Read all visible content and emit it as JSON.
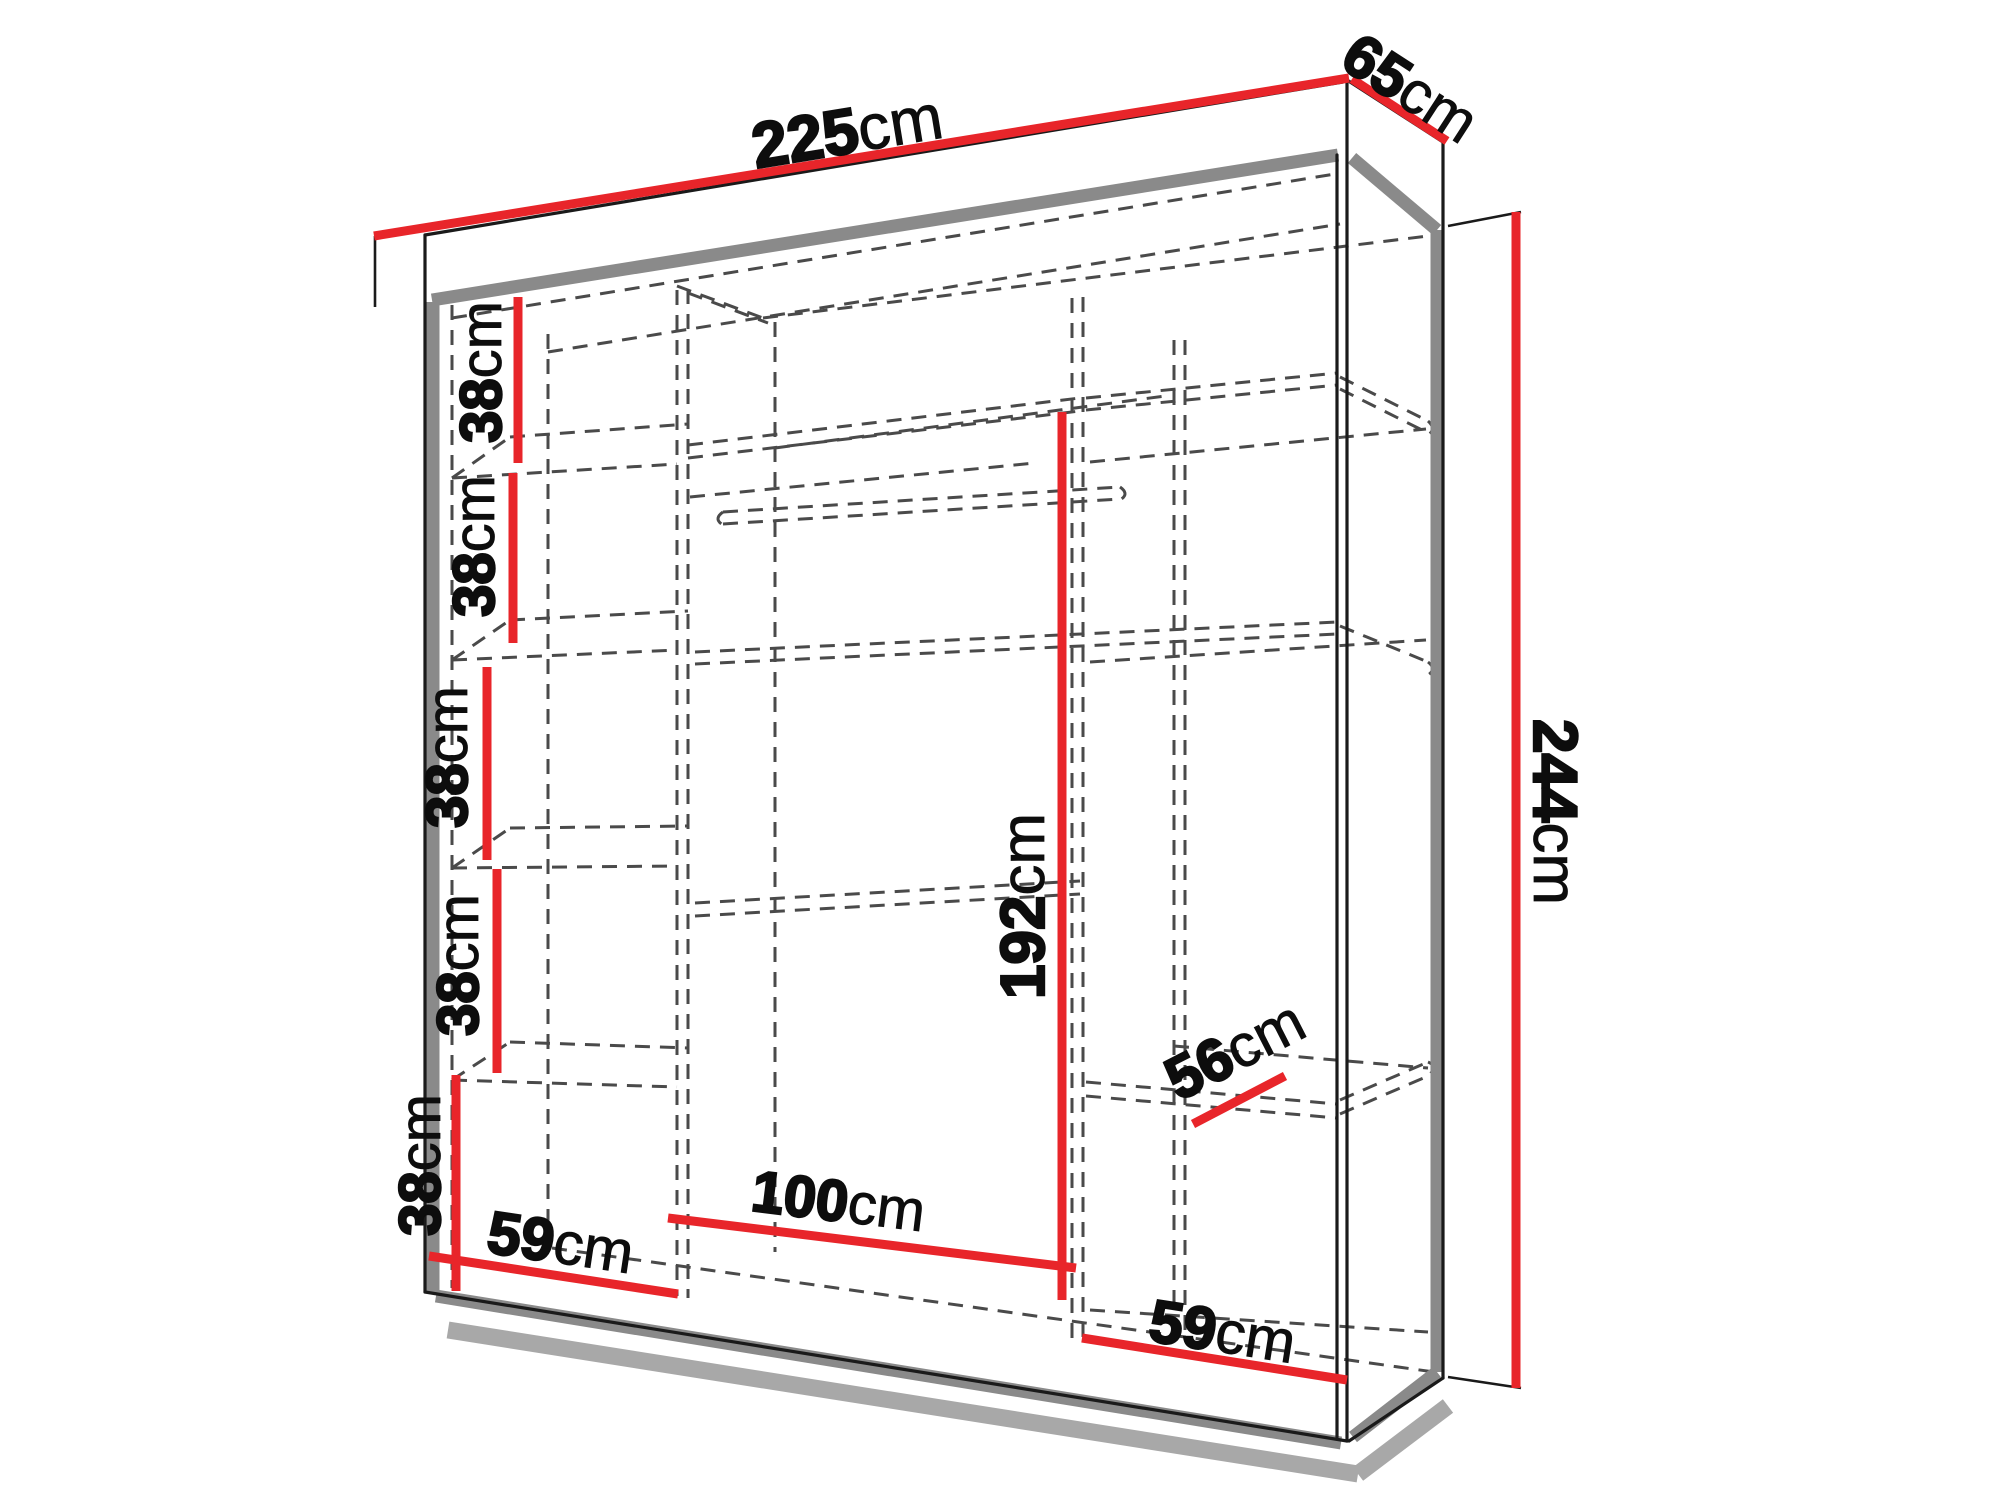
{
  "diagram": {
    "type": "wardrobe-dimension-drawing",
    "unit": "cm",
    "colors": {
      "background": "#ffffff",
      "dimension_line": "#e8252a",
      "outline": "#1a1a1a",
      "panel_edge": "#8a8a8a",
      "hidden_line": "#4a4a4a",
      "label_text": "#0d0d0d"
    },
    "overall": {
      "width": {
        "value": "225",
        "unit": "cm"
      },
      "depth": {
        "value": "65",
        "unit": "cm"
      },
      "height": {
        "value": "244",
        "unit": "cm"
      }
    },
    "interior": {
      "hanging_height": {
        "value": "192",
        "unit": "cm"
      },
      "middle_section_width": {
        "value": "100",
        "unit": "cm"
      },
      "left_section_width": {
        "value": "59",
        "unit": "cm"
      },
      "right_section_width": {
        "value": "59",
        "unit": "cm"
      },
      "shelf_depth": {
        "value": "56",
        "unit": "cm"
      },
      "left_shelf_spacings": [
        {
          "value": "38",
          "unit": "cm"
        },
        {
          "value": "38",
          "unit": "cm"
        },
        {
          "value": "38",
          "unit": "cm"
        },
        {
          "value": "38",
          "unit": "cm"
        },
        {
          "value": "38",
          "unit": "cm"
        }
      ]
    }
  }
}
